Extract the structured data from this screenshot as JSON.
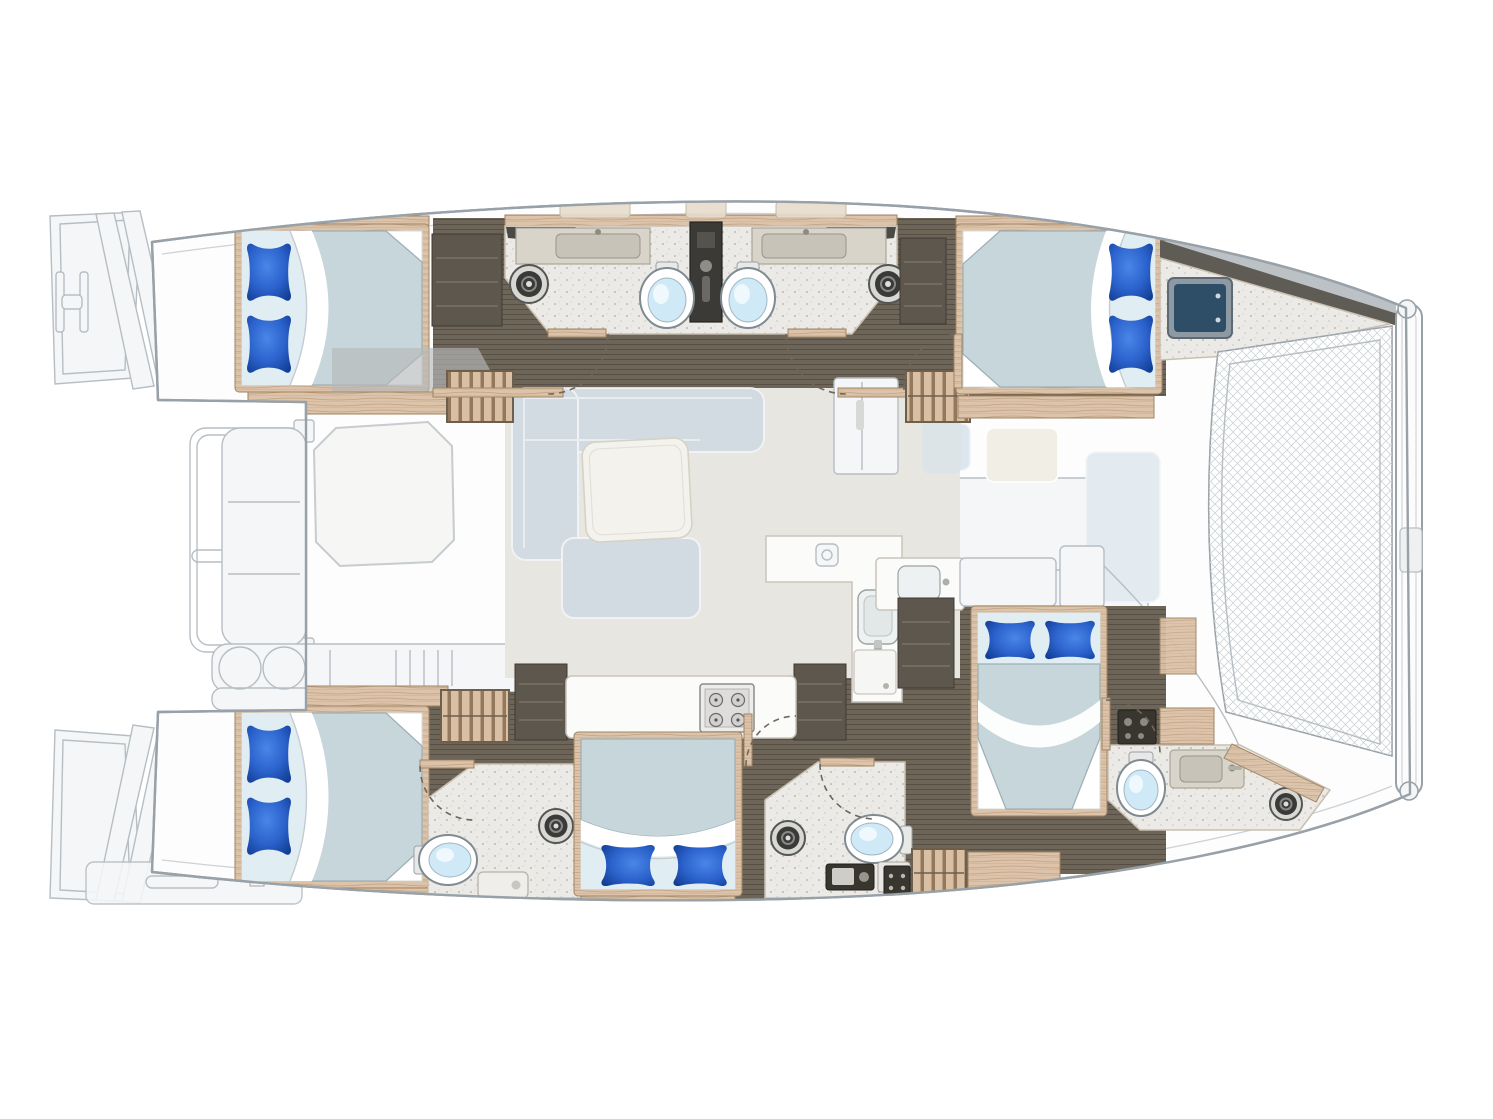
{
  "meta": {
    "description": "Catamaran yacht interior floorplan, top view, bow to the right",
    "image_kind": "boat-floorplan-illustration",
    "visible_text": []
  },
  "layout_facts": {
    "hulls": 2,
    "orientation": {
      "bow": "right",
      "stern": "left"
    },
    "bridge_deck": "central salon and galley between hulls",
    "foredeck": "trampoline net between bows"
  },
  "colors": {
    "hull_stroke": "#99a1a8",
    "ghost_line": "#b6bec4",
    "wood_floor": "#6e6559",
    "wood_trim": "#dcc3a9",
    "bath_floor": "#ebeae6",
    "salon_floor": "#e8e6e1",
    "mattress": "#c6d6da",
    "sheet_pale": "#e0edf2",
    "pillow_light": "#4a86e8",
    "pillow_mid": "#2b62cc",
    "pillow_dark": "#123d93",
    "toilet_bowl": "#cfe9f7",
    "fixture_dark": "#38362f",
    "counter_greige": "#d8d4ca",
    "hatch_navy": "#2e4d66",
    "net_line": "#ced4d8"
  },
  "rooms": [
    {
      "id": "upper-aft-cabin",
      "type": "double-cabin",
      "fixtures": [
        "double-berth",
        "two-pillows",
        "wardrobe",
        "shelf",
        "companionway-steps"
      ]
    },
    {
      "id": "upper-head-port",
      "type": "bathroom",
      "fixtures": [
        "toilet",
        "washbasin-counter",
        "shower-drain"
      ]
    },
    {
      "id": "upper-head-stbd",
      "type": "bathroom",
      "fixtures": [
        "toilet",
        "washbasin-counter",
        "shower-drain",
        "shared-shower-column"
      ]
    },
    {
      "id": "upper-forward-cabin",
      "type": "double-cabin",
      "fixtures": [
        "double-berth",
        "two-pillows",
        "shelf",
        "deck-hatch",
        "companionway-steps"
      ]
    },
    {
      "id": "salon-galley",
      "type": "living-area",
      "fixtures": [
        "l-sofa",
        "coffee-table",
        "refrigerator",
        "l-counter",
        "galley-sink",
        "appliance-panel",
        "island-counter",
        "cooktop-4-burners",
        "storage-columns"
      ]
    },
    {
      "id": "lower-aft-cabin",
      "type": "double-cabin",
      "fixtures": [
        "double-berth",
        "two-pillows",
        "shelves",
        "companionway-steps"
      ]
    },
    {
      "id": "lower-aft-head",
      "type": "bathroom",
      "fixtures": [
        "toilet",
        "washbasin-tray",
        "shower-drain",
        "electrical-panel"
      ]
    },
    {
      "id": "lower-mid-cabin",
      "type": "double-cabin",
      "fixtures": [
        "double-berth",
        "two-pillows"
      ]
    },
    {
      "id": "lower-mid-head",
      "type": "bathroom",
      "fixtures": [
        "toilet",
        "vanity-module",
        "outlet-panel",
        "shower-drain"
      ]
    },
    {
      "id": "lower-forward-cabin",
      "type": "double-cabin",
      "fixtures": [
        "double-berth",
        "two-pillows",
        "wardrobe",
        "companionway-steps",
        "galley-sink-counter"
      ]
    },
    {
      "id": "lower-forward-head",
      "type": "bathroom",
      "fixtures": [
        "toilet",
        "washbasin-counter",
        "electrical-panel",
        "storage-box",
        "shower-drain"
      ]
    },
    {
      "id": "aft-cockpit",
      "type": "exterior-ghost",
      "fixtures": [
        "octagonal-table",
        "bench",
        "console-with-grill-rings",
        "davit-arm",
        "stern-rail"
      ]
    },
    {
      "id": "stern-platforms",
      "type": "exterior",
      "fixtures": [
        "upper-transom-steps",
        "lower-transom-steps",
        "swim-platform",
        "cleat"
      ]
    },
    {
      "id": "foredeck",
      "type": "exterior",
      "fixtures": [
        "trampoline-net",
        "bow-crossbeam",
        "lounge-pads",
        "deck-box"
      ]
    }
  ],
  "fixture_totals": {
    "berths": 5,
    "pillows": 10,
    "toilets": 5,
    "washbasins": 6,
    "shower_drains": 5,
    "companionway_steps": 4,
    "cooktop_burners": 4,
    "deck_hatches": 1,
    "trampolines": 1
  }
}
